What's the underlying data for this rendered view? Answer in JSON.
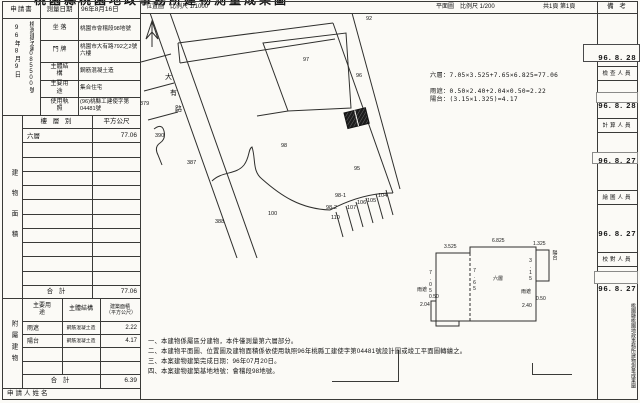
{
  "doc": {
    "title": "桃園縣桃園地政事務所建物測量成果圖",
    "location_map_title": "位置圖",
    "location_map_scale": "比例尺 1/1000",
    "floor_plan_title": "平面圖",
    "floor_plan_scale": "比例尺 1/200",
    "page_info": "共1頁 第1頁"
  },
  "application": {
    "form_label": "申請書",
    "receipt_date_vertical": "96年8月9日",
    "receipt_no_vertical": "桃測建字第085500號",
    "survey_date_label": "測量日期",
    "survey_date": "96年8月16日",
    "rows": [
      {
        "label": "坐 落",
        "value": "桃園市會稽段98地號"
      },
      {
        "label": "門 牌",
        "value": "桃園市大有路792之2號六樓"
      },
      {
        "label": "主體結構",
        "value": "鋼筋混凝土造"
      },
      {
        "label": "主要用途",
        "value": "集合住宅"
      },
      {
        "label": "使用執照",
        "value": "(96)桃縣工建使字第04481號"
      }
    ]
  },
  "area_table": {
    "side_label": "建物面積",
    "floor_header": "樓 層 別",
    "sqm_header": "平方公尺",
    "rows": [
      {
        "floor": "六層",
        "sqm": "77.06"
      }
    ],
    "empty_row_count": 10,
    "total_label": "合  計",
    "total_value": "77.06"
  },
  "annex_table": {
    "side_label": "附屬建物",
    "headers": [
      "主要用途",
      "主體結構",
      "建築面積（平方公尺）"
    ],
    "rows": [
      {
        "use": "雨遮",
        "structure": "鋼筋混凝土造",
        "area": "2.22"
      },
      {
        "use": "陽台",
        "structure": "鋼筋混凝土造",
        "area": "4.17"
      }
    ],
    "empty_row_count": 2,
    "total_label": "合  計",
    "total_value": "6.39"
  },
  "applicant_label": "申請人姓名",
  "map": {
    "road_name": "大有路",
    "road_chars": [
      {
        "t": "大",
        "x": 165,
        "y": 74
      },
      {
        "t": "有",
        "x": 170,
        "y": 90
      },
      {
        "t": "路",
        "x": 175,
        "y": 106
      }
    ],
    "parcels": [
      {
        "t": "97",
        "x": 303,
        "y": 57
      },
      {
        "t": "98",
        "x": 281,
        "y": 143
      },
      {
        "t": "100",
        "x": 268,
        "y": 211
      },
      {
        "t": "387",
        "x": 187,
        "y": 160
      },
      {
        "t": "388",
        "x": 215,
        "y": 219
      },
      {
        "t": "390",
        "x": 155,
        "y": 133
      },
      {
        "t": "379",
        "x": 140,
        "y": 101
      },
      {
        "t": "92",
        "x": 366,
        "y": 16
      },
      {
        "t": "96",
        "x": 356,
        "y": 73
      },
      {
        "t": "95",
        "x": 354,
        "y": 166
      },
      {
        "t": "98-1",
        "x": 335,
        "y": 193
      },
      {
        "t": "98-2",
        "x": 326,
        "y": 205
      },
      {
        "t": "110",
        "x": 331,
        "y": 215
      },
      {
        "t": "107",
        "x": 347,
        "y": 205
      },
      {
        "t": "106",
        "x": 357,
        "y": 200
      },
      {
        "t": "105",
        "x": 367,
        "y": 198
      },
      {
        "t": "104",
        "x": 378,
        "y": 193
      }
    ]
  },
  "calculations": [
    "六層：7.05×3.525+7.65×6.825=77.06",
    "雨遮：0.50×2.40+2.04×0.50=2.22",
    "陽台：(3.15×1.325)=4.17"
  ],
  "floor_plan": {
    "labels": [
      {
        "t": "3.525",
        "x": 444,
        "y": 245
      },
      {
        "t": "6.825",
        "x": 492,
        "y": 239
      },
      {
        "t": "7.05",
        "x": 427,
        "y": 270,
        "v": 1
      },
      {
        "t": "7.65",
        "x": 471,
        "y": 268,
        "v": 1
      },
      {
        "t": "六層",
        "x": 493,
        "y": 277
      },
      {
        "t": "陽台",
        "x": 551,
        "y": 250,
        "v": 1
      },
      {
        "t": "1.325",
        "x": 533,
        "y": 242
      },
      {
        "t": "3.15",
        "x": 527,
        "y": 258,
        "v": 1
      },
      {
        "t": "雨遮",
        "x": 417,
        "y": 288
      },
      {
        "t": "0.50",
        "x": 429,
        "y": 295
      },
      {
        "t": "2.04",
        "x": 420,
        "y": 303
      },
      {
        "t": "雨遮",
        "x": 521,
        "y": 290
      },
      {
        "t": "0.50",
        "x": 536,
        "y": 297
      },
      {
        "t": "2.40",
        "x": 522,
        "y": 304
      }
    ]
  },
  "notes": [
    "一、本建物係屬區分建物，本件僅測量第六層部分。",
    "二、本建物平面圖、位置圖及建物面積係依使用執照96年桃縣工建使字第04481號設計圖或竣工平面圖轉繪之。",
    "三、本案建物建築完成日期：96年07月20日。",
    "四、本案建物建築基地地號：會稽段98地號。"
  ],
  "remarks": {
    "header": "備 考",
    "entries": [
      {
        "date": "96. 8. 28",
        "role": "檢查人員"
      },
      {
        "date": "96. 8. 28",
        "role": "計算人員"
      },
      {
        "date": "96. 8. 27",
        "role": "繪圖人員"
      },
      {
        "date": "96. 8. 27",
        "role": "校對人員"
      },
      {
        "date": "96. 8. 27",
        "role": ""
      }
    ],
    "vertical_note": "桃園縣桃園地政事務所建物測量成果圖"
  }
}
